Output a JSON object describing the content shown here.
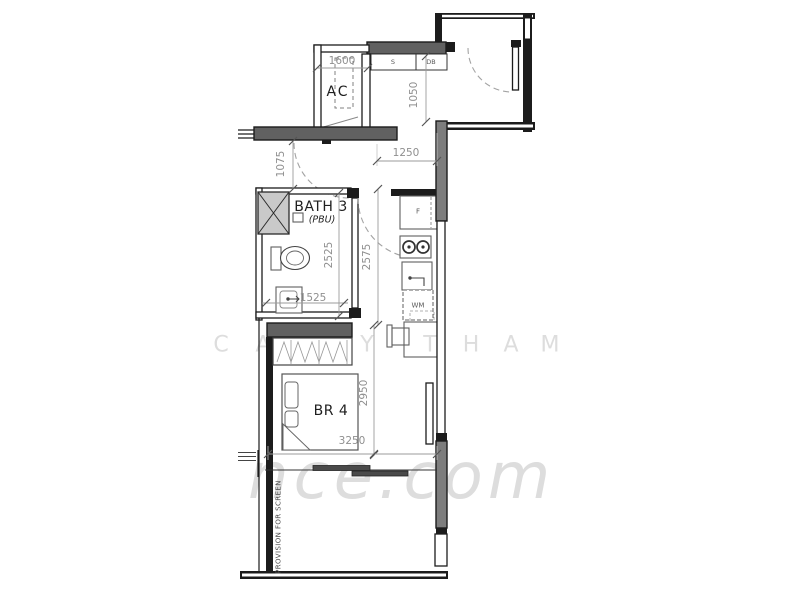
{
  "labels": {
    "ac": "AC",
    "bath": "BATH 3",
    "bath_sub": "(PBU)",
    "bedroom": "BR 4",
    "switch": "S",
    "db": "DB",
    "fridge": "F",
    "washer": "WM",
    "provision": "PROVISION FOR SCREEN"
  },
  "dimensions": {
    "ac_ledge": "1600",
    "entry_depth": "1050",
    "kitchen_width": "1250",
    "foyer": "1075",
    "bath_length": "2525",
    "corridor_length": "2575",
    "bath_width": "1525",
    "bedroom_length": "2950",
    "bedroom_width": "3250"
  },
  "watermark": {
    "letters": [
      "C",
      "A",
      "Y",
      "T",
      "H",
      "A",
      "M"
    ],
    "domain": "nce.com"
  },
  "colors": {
    "wall": "#1c1c1c",
    "structure": "#616161",
    "pier": "#7d7d7d",
    "dimension": "#8f8f8f",
    "label": "#1f1f1f",
    "furniture": "#5f5f5f",
    "watermark": "#dddddd"
  }
}
